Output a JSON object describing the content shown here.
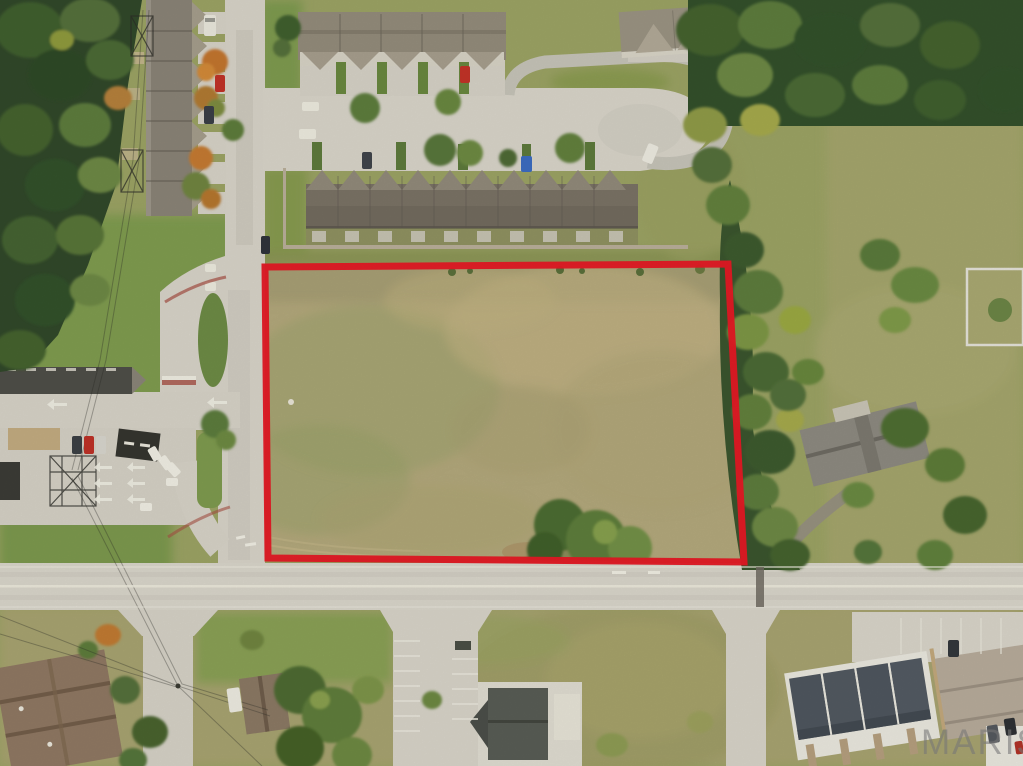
{
  "watermark": {
    "text": "MARIS",
    "color": "#767676"
  },
  "scene": {
    "type": "aerial-photo",
    "subject": "Aerial drone view of a vacant grass parcel outlined in red at a street corner, surrounded by townhome rows, a gas station, roads and trees",
    "parcel_outline": {
      "color": "#e51a24",
      "stroke_width_px": 7,
      "corners_px": [
        [
          265,
          267
        ],
        [
          728,
          264
        ],
        [
          744,
          562
        ],
        [
          268,
          558
        ]
      ]
    },
    "palette": {
      "road_concrete": "#d7d3c8",
      "asphalt_lane": "#c6c3b8",
      "grass_green": "#7f9b4f",
      "grass_olive": "#a4a56c",
      "parcel_field": "#b3a87c",
      "forest_dark": "#33502b",
      "tree_green": "#5d7d3a",
      "tree_yellow": "#9aa843",
      "tree_autumn": "#c07a33",
      "roof_taupe": "#8a8376",
      "roof_long_row": "#7a7265",
      "roof_slate_new": "#4f565e",
      "roof_brown_apartment": "#8f7862",
      "roof_tan_building": "#b7ab9a"
    }
  }
}
